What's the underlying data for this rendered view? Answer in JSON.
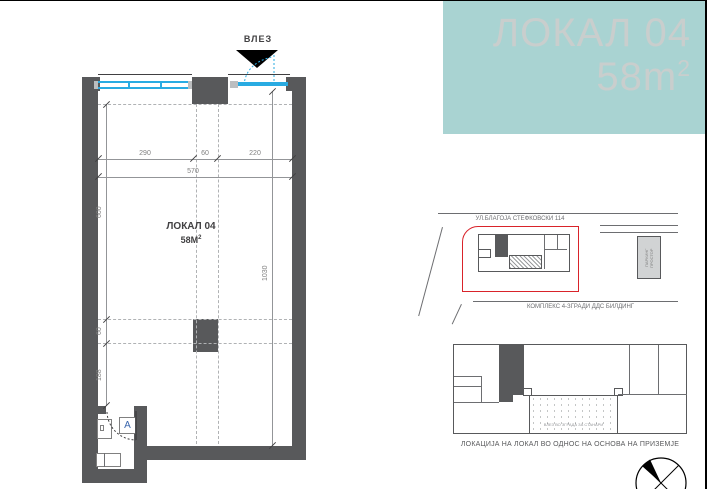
{
  "colors": {
    "teal_bg": "#a9d3d2",
    "teal_text": "#c9cecd",
    "wall": "#58595b",
    "win": "#29abe2",
    "red": "#d9232a"
  },
  "header": {
    "title": "ЛОКАЛ 04",
    "area_value": "58m",
    "area_exp": "2"
  },
  "floor_plan": {
    "entrance_label": "ВЛЕЗ",
    "unit_label": "ЛОКАЛ 04",
    "unit_area_value": "58М",
    "unit_area_exp": "2",
    "door_marker": "A",
    "dim_width_segments": [
      "290",
      "60",
      "220"
    ],
    "dim_width_total": "570",
    "dim_height_segments": [
      "600",
      "60",
      "188"
    ],
    "dim_height_total": "1030"
  },
  "site_plan": {
    "street_label": "УЛ.БЛАГОЈА СТЕФКОВСКИ 114",
    "complex_label": "КОМПЛЕКС 4-ЗГРАДИ  ДДС БИЛДИНГ",
    "parking_label": "ПАРКИНГ ПРОСТОР"
  },
  "ground_plan": {
    "entrance_note": "ВЛЕЗ ВО ЗГРАДА ЗА СТАНАРИ",
    "caption": "ЛОКАЦИЈА НА ЛОКАЛ ВО ОДНОС НА ОСНОВА НА ПРИЗЕМЈЕ"
  }
}
